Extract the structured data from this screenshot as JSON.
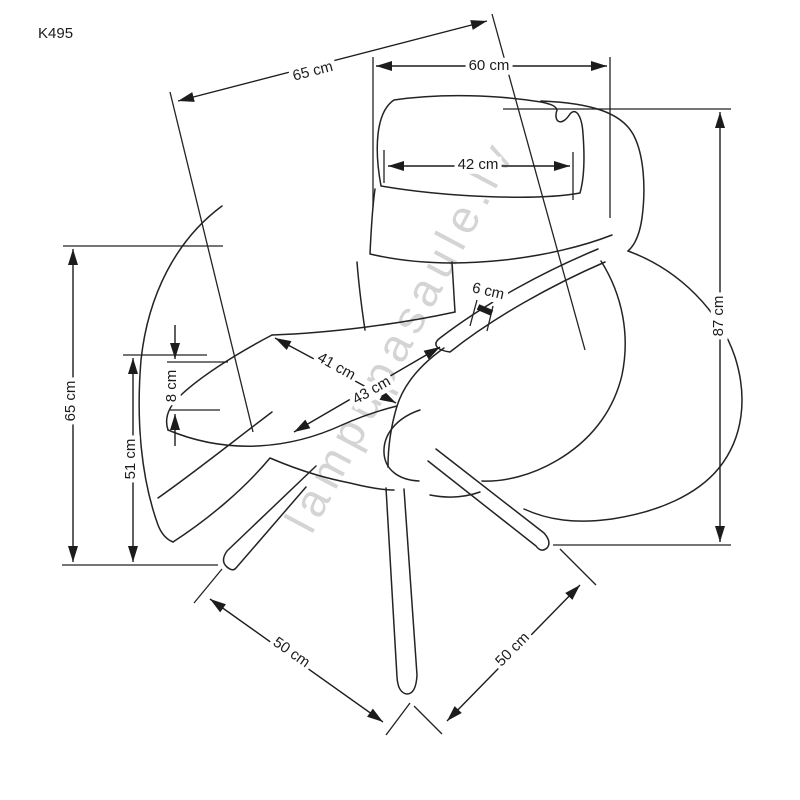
{
  "title": "K495",
  "watermark": "lampupasaule.lv",
  "units": "cm",
  "dimensions": {
    "top_depth": "65 cm",
    "top_width": "60 cm",
    "headrest_width": "42 cm",
    "total_height": "87 cm",
    "armrest_height": "65 cm",
    "seat_height": "51 cm",
    "seat_cushion_thickness": "8 cm",
    "armrest_thickness": "6 cm",
    "seat_width": "41 cm",
    "seat_depth": "43 cm",
    "base_span_left": "50 cm",
    "base_span_right": "50 cm"
  }
}
